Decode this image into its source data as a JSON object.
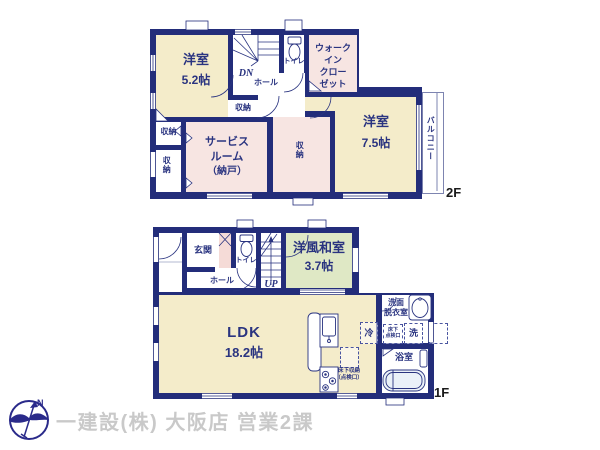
{
  "colors": {
    "wall": "#232d7a",
    "room_cream": "#f4ecca",
    "room_pink": "#f7e5e2",
    "room_green": "#dfe8c5",
    "label_text": "#2a3480",
    "footer_text": "#c9c9c9"
  },
  "floor2": {
    "floor_label": "2F",
    "yoshitsu52": {
      "name": "洋室",
      "size": "5.2帖"
    },
    "yoshitsu75": {
      "name": "洋室",
      "size": "7.5帖"
    },
    "service_room": {
      "line1": "サービス",
      "line2": "ルーム",
      "line3": "（納戸）"
    },
    "wic": {
      "line1": "ウォーク",
      "line2": "イン",
      "line3": "クロー",
      "line4": "ゼット"
    },
    "balcony": "バルコニー",
    "toilet": "トイレ",
    "hall": "ホール",
    "stairs_down": "DN",
    "closet_a": "収納",
    "closet_b": "収納",
    "closet_c": "収納",
    "closet_d": "収納"
  },
  "floor1": {
    "floor_label": "1F",
    "genkan": "玄関",
    "toilet": "トイレ",
    "hall": "ホール",
    "stairs_up": "UP",
    "washitsu": {
      "name": "洋風和室",
      "size": "3.7帖"
    },
    "ldk": {
      "name": "LDK",
      "size": "18.2帖"
    },
    "senmen": {
      "line1": "洗面",
      "line2": "脱衣室"
    },
    "bath": "浴室",
    "fridge": "冷",
    "washer": "洗",
    "underfloor_hatch": {
      "line1": "床下",
      "line2": "点検口"
    },
    "underfloor_storage": {
      "line1": "床下収納",
      "line2": "（点検口）"
    }
  },
  "footer": {
    "company": "一建設(株) 大阪店 営業2課"
  },
  "compass": {
    "north": "N"
  }
}
